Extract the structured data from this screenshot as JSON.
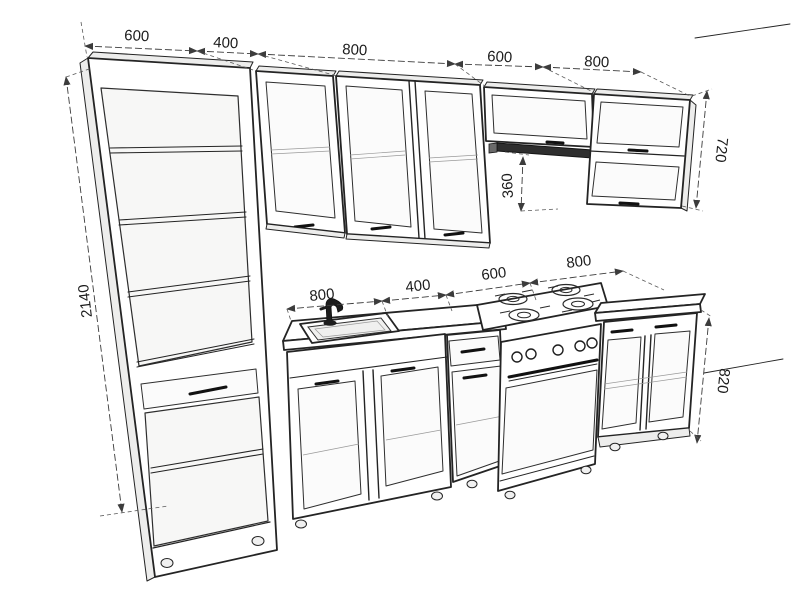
{
  "dimensions": {
    "top_row": [
      "600",
      "400",
      "800",
      "600",
      "800"
    ],
    "tall_cabinet_height": "2140",
    "wall_cabinet_height": "720",
    "hood_clearance": "360",
    "counter_row": [
      "800",
      "400",
      "600",
      "800"
    ],
    "base_cabinet_height": "820"
  },
  "colors": {
    "line": "#242424",
    "dim_line": "#3c3c3c",
    "shade_light": "#f7f7f6",
    "shade_mid": "#ededec",
    "extractor_dark": "#2e2e2e",
    "background": "#ffffff"
  }
}
